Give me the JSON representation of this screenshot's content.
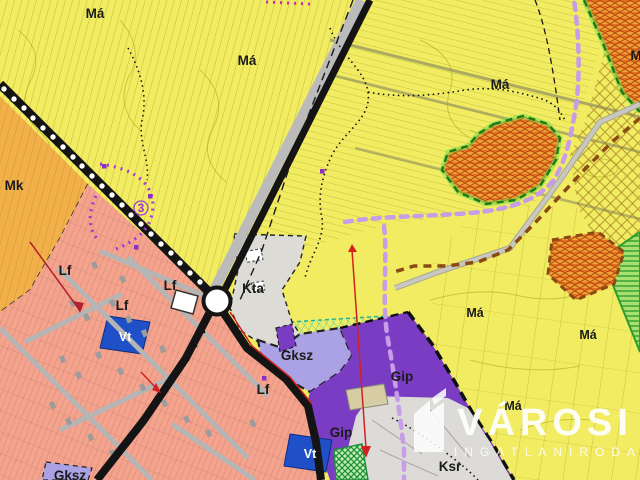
{
  "map": {
    "labels": [
      {
        "text": "Má"
      },
      {
        "text": "Má"
      },
      {
        "text": "Má"
      },
      {
        "text": "M"
      },
      {
        "text": "Mk"
      },
      {
        "text": "Lf"
      },
      {
        "text": "Lf"
      },
      {
        "text": "Lf"
      },
      {
        "text": "Kta"
      },
      {
        "text": "Vt"
      },
      {
        "text": "Gksz"
      },
      {
        "text": "Lf"
      },
      {
        "text": "Gip"
      },
      {
        "text": "Gip"
      },
      {
        "text": "Vt"
      },
      {
        "text": "Ksr"
      },
      {
        "text": "Gksz"
      },
      {
        "text": "Má"
      },
      {
        "text": "Má"
      },
      {
        "text": "Má"
      },
      {
        "text": "3"
      }
    ],
    "watermark": {
      "title": "VÁROSI",
      "subtitle": "INGATLANIRODA"
    },
    "colors": {
      "ma": "#f1ec62",
      "mk": "#f3b04a",
      "lf": "#f5a38d",
      "vt": "#2050c8",
      "gksz": "#aaa2e4",
      "gip": "#7b3cc4",
      "kta": "#dcdbd6",
      "ksr": "#dcdbd7",
      "teal_overlay": "#2fd6c0",
      "forest_orange": "#efa037",
      "green_zone": "#a8e070",
      "violet_route": "#c79ce8",
      "brown_boundary": "#8a4a14",
      "green_boundary": "#1d7a16",
      "road_black": "#141414",
      "road_gray": "#b9b9b9",
      "red_line": "#d42020",
      "purple_route": "#a23bd6"
    }
  }
}
